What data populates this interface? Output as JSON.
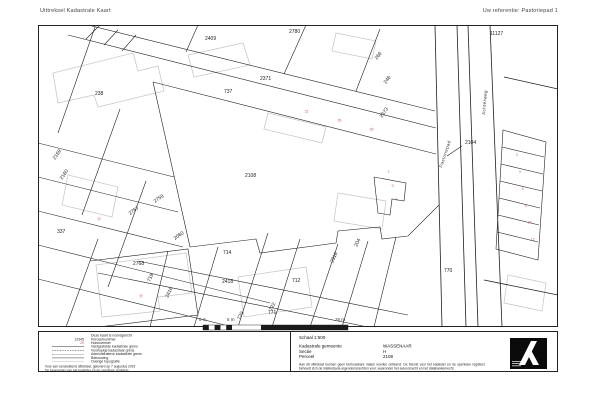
{
  "header": {
    "title": "Uittreksel Kadastrale Kaart",
    "reference": "Uw referentie: Pastoriepad 1"
  },
  "map": {
    "scale_labels": [
      "0 m",
      "5 m",
      "25 m"
    ],
    "labels": [
      {
        "t": "2409",
        "x": 167,
        "y": 15,
        "k": "p"
      },
      {
        "t": "2780",
        "x": 251,
        "y": 8,
        "k": "p"
      },
      {
        "t": "2371",
        "x": 222,
        "y": 55,
        "k": "p"
      },
      {
        "t": "737",
        "x": 186,
        "y": 68,
        "k": "p"
      },
      {
        "t": "238",
        "x": 57,
        "y": 70,
        "k": "p"
      },
      {
        "t": "11127",
        "x": 452,
        "y": 10,
        "k": "p"
      },
      {
        "t": "2104",
        "x": 427,
        "y": 119,
        "k": "p"
      },
      {
        "t": "2108",
        "x": 207,
        "y": 152,
        "k": "p",
        "fs": 6
      },
      {
        "t": "2768",
        "x": 95,
        "y": 240,
        "k": "p"
      },
      {
        "t": "714",
        "x": 185,
        "y": 229,
        "k": "p"
      },
      {
        "t": "2418",
        "x": 184,
        "y": 258,
        "k": "p"
      },
      {
        "t": "712",
        "x": 254,
        "y": 257,
        "k": "p"
      },
      {
        "t": "770",
        "x": 406,
        "y": 247,
        "k": "p"
      },
      {
        "t": "771",
        "x": 230,
        "y": 289,
        "k": "p"
      },
      {
        "t": "266",
        "x": 339,
        "y": 35,
        "r": -55,
        "k": "p"
      },
      {
        "t": "246",
        "x": 348,
        "y": 59,
        "r": -55,
        "k": "p"
      },
      {
        "t": "2373",
        "x": 344,
        "y": 93,
        "r": -55,
        "k": "p"
      },
      {
        "t": "2159",
        "x": 17,
        "y": 135,
        "r": -55,
        "k": "p"
      },
      {
        "t": "2160",
        "x": 24,
        "y": 155,
        "r": -55,
        "k": "p"
      },
      {
        "t": "2759",
        "x": 117,
        "y": 178,
        "r": -35,
        "k": "p"
      },
      {
        "t": "2767",
        "x": 92,
        "y": 190,
        "r": -35,
        "k": "p"
      },
      {
        "t": "337",
        "x": 19,
        "y": 208,
        "k": "p"
      },
      {
        "t": "2060",
        "x": 137,
        "y": 215,
        "r": -35,
        "k": "p"
      },
      {
        "t": "719",
        "x": 112,
        "y": 257,
        "r": -65,
        "k": "p"
      },
      {
        "t": "2416",
        "x": 130,
        "y": 273,
        "r": -65,
        "k": "p"
      },
      {
        "t": "720",
        "x": 202,
        "y": 295,
        "r": -65,
        "k": "p"
      },
      {
        "t": "722",
        "x": 234,
        "y": 286,
        "r": -65,
        "k": "p"
      },
      {
        "t": "204",
        "x": 319,
        "y": 222,
        "r": -65,
        "k": "p"
      },
      {
        "t": "2916",
        "x": 295,
        "y": 238,
        "r": -65,
        "k": "p"
      },
      {
        "t": "Pastoriepad",
        "x": 404,
        "y": 143,
        "r": -72,
        "k": "s"
      },
      {
        "t": "Achterweg",
        "x": 447,
        "y": 90,
        "r": -85,
        "k": "s"
      },
      {
        "t": "22",
        "x": 267,
        "y": 88,
        "r": -15,
        "k": "h"
      },
      {
        "t": "26",
        "x": 300,
        "y": 97,
        "r": -15,
        "k": "h"
      },
      {
        "t": "28",
        "x": 332,
        "y": 106,
        "r": -15,
        "k": "h"
      },
      {
        "t": "1",
        "x": 350,
        "y": 148,
        "r": -15,
        "k": "h"
      },
      {
        "t": "3",
        "x": 354,
        "y": 162,
        "r": -15,
        "k": "h"
      },
      {
        "t": "5",
        "x": 358,
        "y": 176,
        "r": -15,
        "k": "h"
      },
      {
        "t": "2",
        "x": 478,
        "y": 131,
        "r": -10,
        "k": "h"
      },
      {
        "t": "4",
        "x": 481,
        "y": 148,
        "r": -10,
        "k": "h"
      },
      {
        "t": "6",
        "x": 484,
        "y": 165,
        "r": -10,
        "k": "h"
      },
      {
        "t": "8",
        "x": 487,
        "y": 182,
        "r": -10,
        "k": "h"
      },
      {
        "t": "10",
        "x": 490,
        "y": 199,
        "r": -10,
        "k": "h"
      },
      {
        "t": "12",
        "x": 493,
        "y": 216,
        "r": -10,
        "k": "h"
      },
      {
        "t": "23",
        "x": 102,
        "y": 273,
        "r": -35,
        "k": "h"
      },
      {
        "t": "15",
        "x": 60,
        "y": 196,
        "r": -35,
        "k": "h"
      }
    ]
  },
  "legend": {
    "rows": [
      {
        "sym": "",
        "kind": "none",
        "label": "Deze kaart is noordgericht"
      },
      {
        "sym": "12345",
        "kind": "text",
        "label": "Perceelnummer"
      },
      {
        "sym": "25",
        "kind": "text-pink",
        "label": "Huisnummer"
      },
      {
        "sym": "",
        "kind": "line-solid",
        "label": "Vastgestelde kadastrale grens"
      },
      {
        "sym": "",
        "kind": "line-dashed",
        "label": "Voorlopige kadastrale grens"
      },
      {
        "sym": "",
        "kind": "line-dashdot",
        "label": "Administratieve kadastrale grens"
      },
      {
        "sym": "",
        "kind": "swatch",
        "label": "Bebouwing"
      },
      {
        "sym": "",
        "kind": "line-gray",
        "label": "Overige topografie"
      }
    ],
    "footer1": "Voor een eensluidend uittreksel, geleverd op 7 augustus 2019",
    "footer2": "De bewaarder van het kadaster en de openbare registers"
  },
  "info": {
    "scale": "Schaal 1:500",
    "rows": [
      {
        "label": "Kadastrale gemeente",
        "value": "WASSENAAR"
      },
      {
        "label": "Sectie",
        "value": "H"
      },
      {
        "label": "Perceel",
        "value": "2108"
      }
    ],
    "disclaimer": "Aan dit uittreksel kunnen geen betrouwbare maten worden ontleend. De Dienst voor het kadaster en de openbare registers behoudt zich de intellectuele eigendomsrechten voor, waaronder het auteursrecht en het databankenrecht."
  },
  "colors": {
    "parcel_line": "#1f1f1f",
    "building_line": "#c9c9c9",
    "house_number": "#c25a6a",
    "logo_bg": "#0a0a0a"
  }
}
